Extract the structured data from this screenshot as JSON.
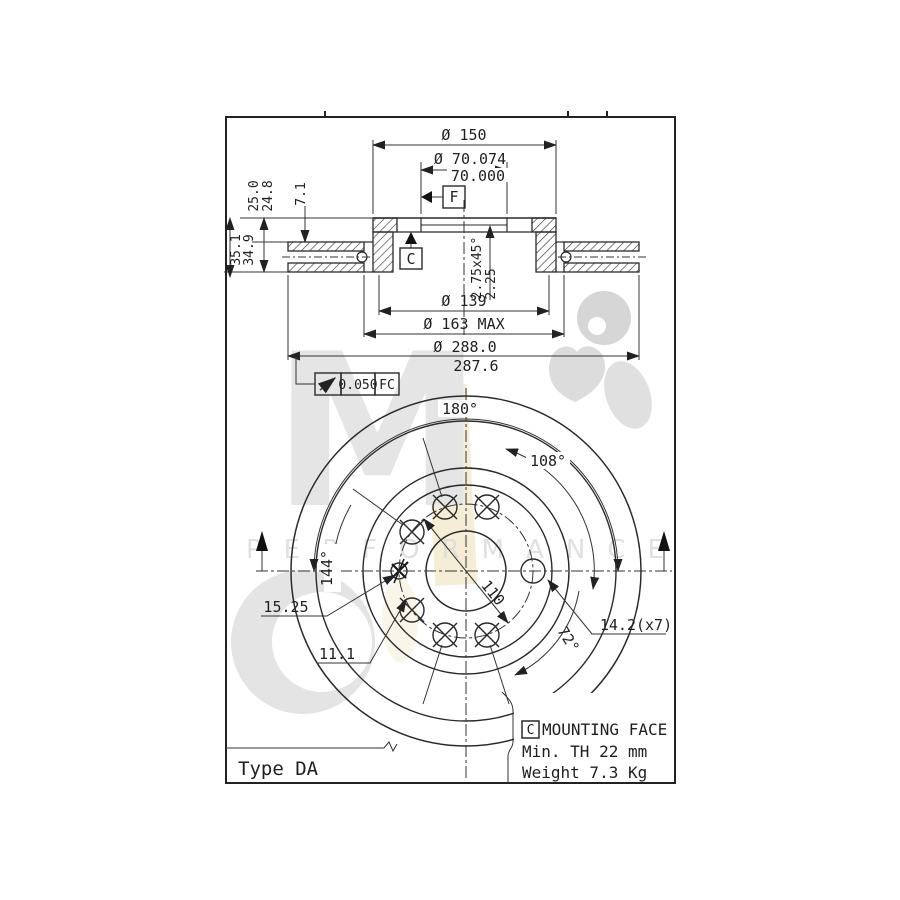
{
  "meta": {
    "description": "Brake disc technical drawing",
    "type_label": "Type DA"
  },
  "watermark": {
    "letter_m": "M",
    "performance_text": "PERFORMANCE"
  },
  "colors": {
    "line": "#2a2a2a",
    "dim_text": "#1f1f1f",
    "watermark_grey": "#e4e4e4",
    "watermark_beige": "#f2e8cc",
    "background": "#ffffff"
  },
  "section_view": {
    "dim_outer_flange": "Ø 150",
    "dim_bore_upper": "Ø 70.074",
    "dim_bore_lower": "70.000",
    "datum_f": "F",
    "datum_c": "C",
    "dim_disc_thickness_upper": "25.0",
    "dim_disc_thickness_lower": "24.8",
    "dim_overall_upper": "35.1",
    "dim_overall_lower": "34.9",
    "dim_flange_depth": "7.1",
    "chamfer_note_1": "2.75x45°",
    "chamfer_note_2": "2.25",
    "dim_hat_bottom": "Ø 139",
    "dim_inner_max": "Ø 163 MAX",
    "dim_outer_upper": "Ø 288.0",
    "dim_outer_lower": "287.6",
    "flatness_value": "0.050",
    "flatness_datum": "FC"
  },
  "front_view": {
    "angle_180": "180°",
    "angle_108": "108°",
    "angle_144": "144°",
    "angle_72": "72°",
    "bolt_circle_dia": "110",
    "locating_dim_1": "15.25",
    "locating_dim_2": "11.1",
    "hole_dia": "14.2(x7)"
  },
  "notes": {
    "mount_datum": "C",
    "mount_title": "MOUNTING FACE",
    "min_thickness": "Min. TH 22 mm",
    "weight": "Weight 7.3 Kg"
  }
}
